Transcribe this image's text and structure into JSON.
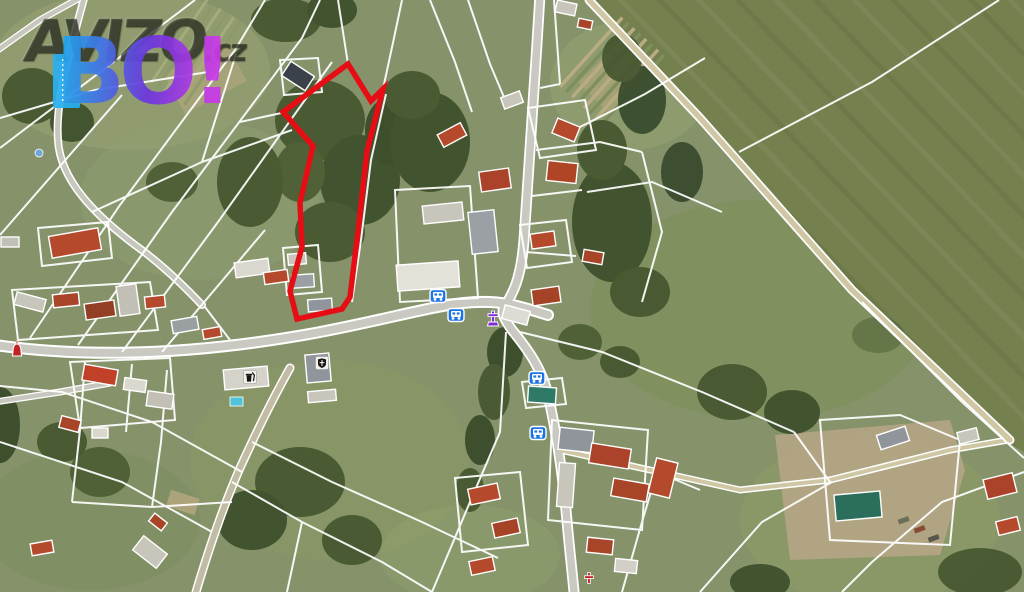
{
  "logo": {
    "brand": "AVIZO",
    "tld": ".cz",
    "shout": "BO!"
  },
  "map": {
    "kind": "aerial-cadastral-map",
    "highlight_color": "#e60d15",
    "parcel_outline_points": "283,112 348,64 371,101 383,89 367,151 358,232 350,297 342,309 297,319 290,291 302,247 300,203 313,146",
    "icons": [
      {
        "type": "bus-stop",
        "x": 438,
        "y": 296
      },
      {
        "type": "bus-stop",
        "x": 456,
        "y": 315
      },
      {
        "type": "bus-stop",
        "x": 537,
        "y": 378
      },
      {
        "type": "bus-stop",
        "x": 538,
        "y": 433
      },
      {
        "type": "monument",
        "x": 493,
        "y": 319
      },
      {
        "type": "waste-bin",
        "x": 250,
        "y": 377
      },
      {
        "type": "shield",
        "x": 322,
        "y": 363
      },
      {
        "type": "chapel",
        "x": 17,
        "y": 351
      },
      {
        "type": "cross",
        "x": 589,
        "y": 578
      }
    ],
    "palette": {
      "cadastral_line": "#ffffff",
      "bus_icon_blue": "#1b74e4",
      "monument_purple": "#7e2bd4",
      "chapel_red": "#c32222",
      "road_gray": "#c9c9c1",
      "track_tan": "#cfc7a4",
      "field_green": "#75804f",
      "grass_green": "#85926a"
    }
  }
}
